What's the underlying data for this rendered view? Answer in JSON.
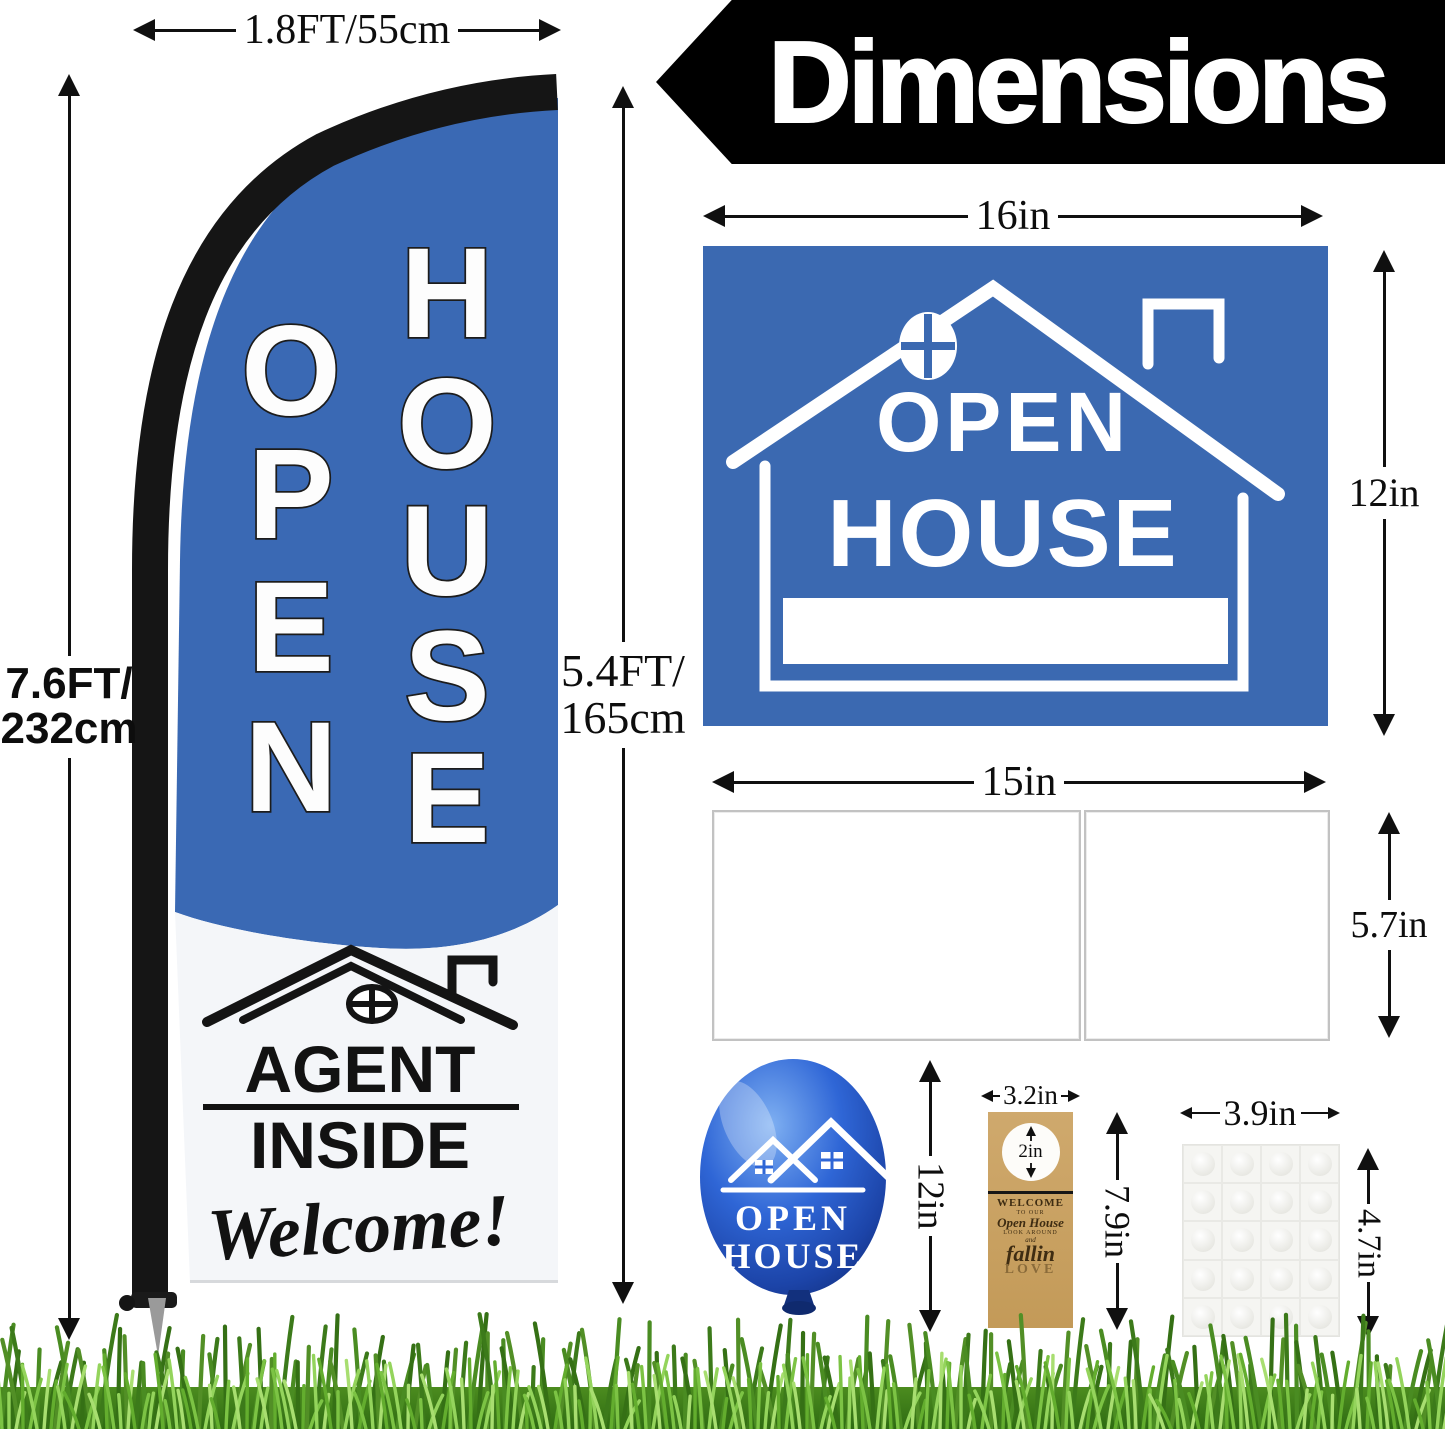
{
  "title": "Dimensions",
  "colors": {
    "flag_blue": "#3a69b4",
    "sign_blue": "#3b69b1",
    "banner_black": "#000000",
    "kraft": "#c8a267",
    "grass_green": "#5ea32c"
  },
  "flag": {
    "width_label": "1.8FT/55cm",
    "total_height_line1": "7.6FT/",
    "total_height_line2": "232cm",
    "flag_height_line1": "5.4FT/",
    "flag_height_line2": "165cm",
    "letters_col1": [
      "O",
      "P",
      "E",
      "N"
    ],
    "letters_col2": [
      "H",
      "O",
      "U",
      "S",
      "E"
    ],
    "bottom_line1": "AGENT",
    "bottom_line2": "INSIDE",
    "bottom_line3": "Welcome!"
  },
  "sign": {
    "width_label": "16in",
    "height_label": "12in",
    "line1": "OPEN",
    "line2": "HOUSE"
  },
  "stake": {
    "width_label": "15in",
    "height_label": "5.7in"
  },
  "balloon": {
    "height_label": "12in",
    "line1": "OPEN",
    "line2": "HOUSE"
  },
  "door_hanger": {
    "width_label": "3.2in",
    "hole_label": "2in",
    "height_label": "7.9in",
    "text_line1": "WELCOME",
    "text_line2": "TO OUR",
    "text_line3": "Open House",
    "text_line4": "LOOK AROUND",
    "text_line5": "and",
    "text_line6": "fallin",
    "text_line7": "LOVE"
  },
  "glue_dots": {
    "width_label": "3.9in",
    "height_label": "4.7in"
  }
}
